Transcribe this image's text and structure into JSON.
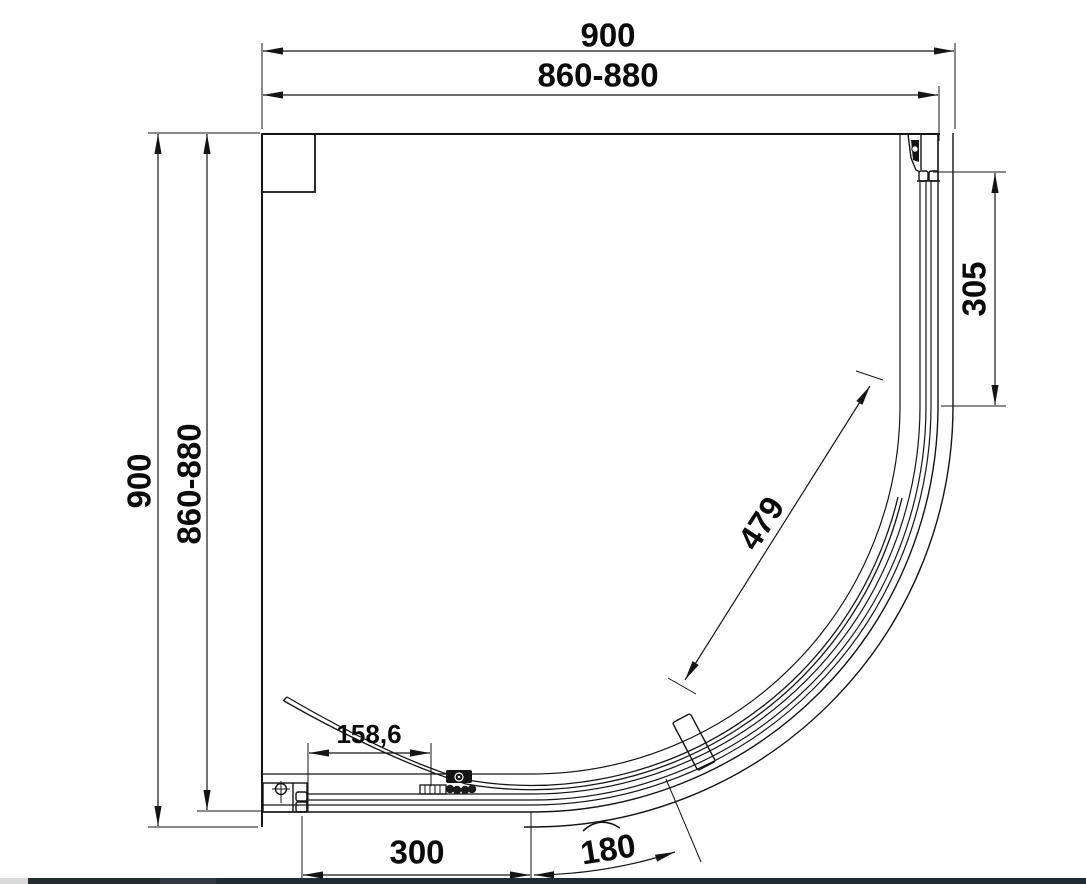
{
  "drawing": {
    "subject": "Quadrant shower enclosure - plan view technical drawing",
    "dims": {
      "top_overall": "900",
      "top_adjust": "860-880",
      "left_overall": "900",
      "left_adjust": "860-880",
      "side_panel": "305",
      "door_width": "479",
      "door_inset": "158,6",
      "opening": "300",
      "arc_opening": "180"
    },
    "line_color": "#141414",
    "text_color": "#0a0a0a",
    "background": "#ffffff"
  },
  "footer_bar": {
    "segments": [
      {
        "name": "left-light",
        "color": "#d9d9d9"
      },
      {
        "name": "dark-1",
        "color": "#232a2e"
      },
      {
        "name": "dark-2",
        "color": "#323a3f"
      },
      {
        "name": "dark-3",
        "color": "#1f2a31"
      }
    ]
  }
}
